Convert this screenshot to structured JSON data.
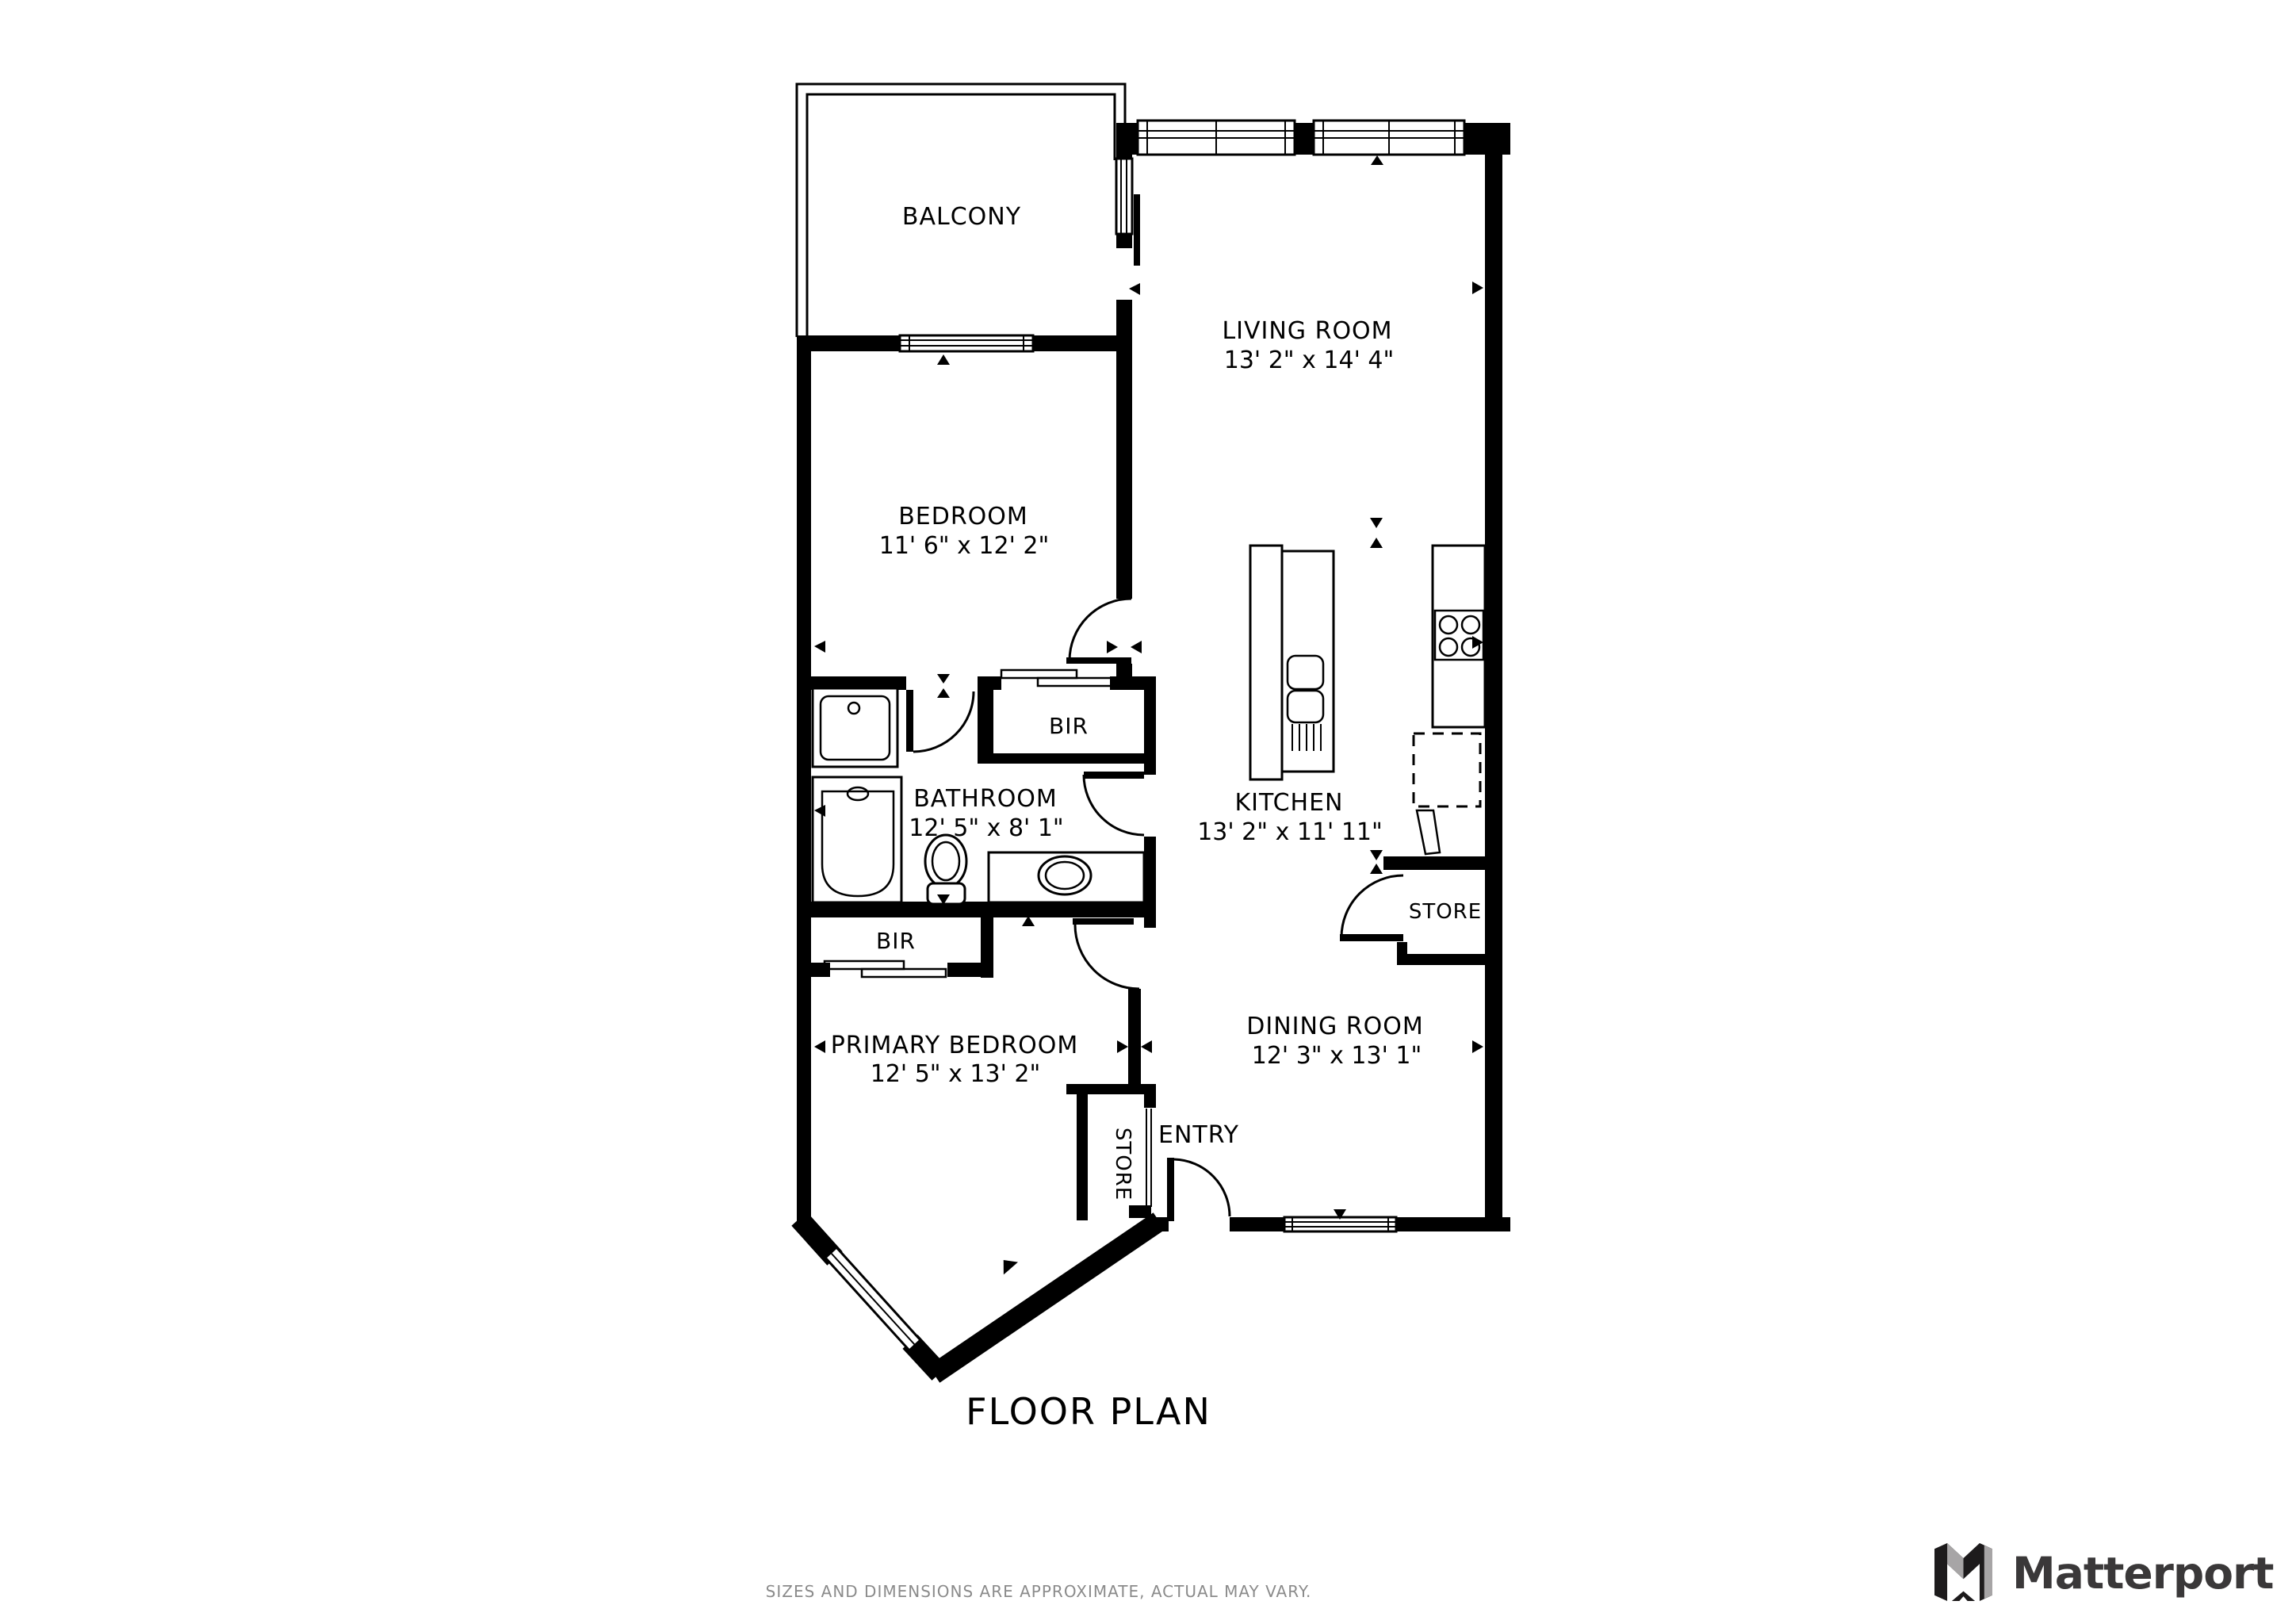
{
  "rooms": {
    "balcony": {
      "name": "BALCONY"
    },
    "living": {
      "name": "LIVING ROOM",
      "dims": "13' 2\" x 14' 4\""
    },
    "bedroom": {
      "name": "BEDROOM",
      "dims": "11' 6\" x 12' 2\""
    },
    "bathroom": {
      "name": "BATHROOM",
      "dims": "12' 5\" x 8' 1\""
    },
    "kitchen": {
      "name": "KITCHEN",
      "dims": "13' 2\" x 11' 11\""
    },
    "dining": {
      "name": "DINING ROOM",
      "dims": "12' 3\" x 13' 1\""
    },
    "primary": {
      "name": "PRIMARY BEDROOM",
      "dims": "12' 5\" x 13' 2\""
    },
    "bir_bedroom": {
      "name": "BIR"
    },
    "bir_primary": {
      "name": "BIR"
    },
    "store_kitchen": {
      "name": "STORE"
    },
    "store_entry": {
      "name": "STORE"
    },
    "entry": {
      "name": "ENTRY"
    }
  },
  "title": "FLOOR PLAN",
  "disclaimer": "SIZES AND DIMENSIONS ARE APPROXIMATE, ACTUAL MAY VARY.",
  "brand": {
    "name": "Matterport"
  },
  "colors": {
    "wall": "#000000",
    "text": "#000000",
    "disclaimer_text": "#8b8b8b",
    "logo_text": "#3a3839",
    "logo_gray": "#a7a5a6"
  }
}
